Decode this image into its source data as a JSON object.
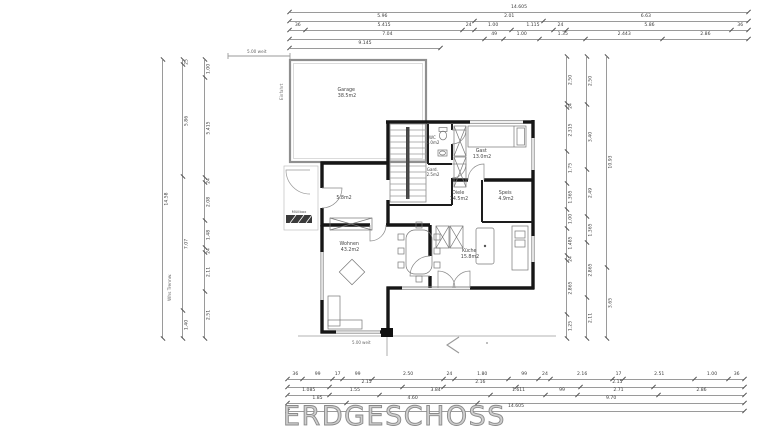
{
  "title": "ERDGESCHOSS",
  "plan": {
    "rooms": [
      {
        "name": "Garage",
        "area": "38.5m2"
      },
      {
        "name": "WC",
        "area": "2.0m2"
      },
      {
        "name": "Gast",
        "area": "13.0m2"
      },
      {
        "name": "Gard.",
        "area": "2.5m2"
      },
      {
        "name": "Diele",
        "area": "14.5m2"
      },
      {
        "name": "Speis",
        "area": "4.9m2"
      },
      {
        "name": "Küche",
        "area": "15.8m2"
      },
      {
        "name": "Wohnen",
        "area": "43.2m2"
      },
      {
        "name": "",
        "area": "5.8m2"
      }
    ],
    "annotations": {
      "fence_top": "5.00 weit",
      "ramp_side": "Einfahrt",
      "bin_label": "Müllbox",
      "terrace_label": "5.00 weit",
      "wall_note": "Whs Trennw."
    },
    "colors": {
      "wall": "#161616",
      "thin_line": "#9a9a9a",
      "dim_text": "#3b3b3b"
    }
  },
  "dimensions": {
    "top": [
      [
        {
          "v": 14.605,
          "l": "14.605"
        }
      ],
      [
        {
          "v": 5.96,
          "l": "5.96"
        },
        {
          "v": 2.01,
          "l": "2.01"
        },
        {
          "v": 6.63,
          "l": "6.63"
        }
      ],
      [
        {
          "v": 0.365,
          "l": "36"
        },
        {
          "v": 5.415,
          "l": "5.415"
        },
        {
          "v": 0.24,
          "l": "24"
        },
        {
          "v": 1.0,
          "l": "1.00"
        },
        {
          "v": 1.115,
          "l": "1.115"
        },
        {
          "v": 0.24,
          "l": "24"
        },
        {
          "v": 5.86,
          "l": "5.86"
        },
        {
          "v": 0.365,
          "l": "36"
        }
      ],
      [
        {
          "v": 7.04,
          "l": "7.04"
        },
        {
          "v": 0.49,
          "l": "49"
        },
        {
          "v": 1.0,
          "l": "1.00"
        },
        {
          "v": 1.35,
          "l": "1.35"
        },
        {
          "v": 2.443,
          "l": "2.443"
        },
        {
          "v": 2.86,
          "l": "2.86"
        }
      ],
      [
        {
          "v": 9.145,
          "l": "9.145"
        }
      ]
    ],
    "bottom": [
      [
        {
          "v": 0.365,
          "l": "36"
        },
        {
          "v": 0.99,
          "l": "99"
        },
        {
          "v": 0.175,
          "l": "17"
        },
        {
          "v": 0.99,
          "l": "99"
        },
        {
          "v": 2.5,
          "l": "2.50"
        },
        {
          "v": 0.24,
          "l": "24"
        },
        {
          "v": 1.8,
          "l": "1.80"
        },
        {
          "v": 0.99,
          "l": "99"
        },
        {
          "v": 0.24,
          "l": "24"
        },
        {
          "v": 2.16,
          "l": "2.16"
        },
        {
          "v": 0.175,
          "l": "17"
        },
        {
          "v": 2.51,
          "l": "2.51"
        },
        {
          "v": 1.0,
          "l": "1.00"
        },
        {
          "v": 0.365,
          "l": "36"
        }
      ],
      [
        {
          "v": 1.45,
          "l": ""
        },
        {
          "v": 2.15,
          "l": "2.15"
        },
        {
          "v": 1.4,
          "l": ""
        },
        {
          "v": 2.16,
          "l": "2.16"
        },
        {
          "v": 2.2,
          "l": ""
        },
        {
          "v": 2.15,
          "l": "2.15"
        },
        {
          "v": 3.1,
          "l": ""
        }
      ],
      [
        {
          "v": 1.085,
          "l": "1.085"
        },
        {
          "v": 1.55,
          "l": "1.55"
        },
        {
          "v": 3.84,
          "l": "3.84"
        },
        {
          "v": 1.611,
          "l": "1.611"
        },
        {
          "v": 0.99,
          "l": "99"
        },
        {
          "v": 2.71,
          "l": "2.71"
        },
        {
          "v": 2.86,
          "l": "2.86"
        }
      ],
      [
        {
          "v": 1.85,
          "l": "1.85"
        },
        {
          "v": 4.6,
          "l": "4.60"
        },
        {
          "v": 9.7,
          "l": "9.70"
        }
      ],
      [
        {
          "v": 14.605,
          "l": "14.605"
        }
      ]
    ],
    "left": [
      [
        {
          "v": 14.58,
          "l": "14.58"
        }
      ],
      [
        {
          "v": 0.25,
          "l": "25"
        },
        {
          "v": 5.86,
          "l": "5.86"
        },
        {
          "v": 7.07,
          "l": "7.07"
        },
        {
          "v": 1.4,
          "l": "1.40"
        }
      ],
      [
        {
          "v": 1.0,
          "l": "1.00"
        },
        {
          "v": 5.415,
          "l": "5.415"
        },
        {
          "v": 0.24,
          "l": "24"
        },
        {
          "v": 2.08,
          "l": "2.08"
        },
        {
          "v": 1.48,
          "l": "1.48"
        },
        {
          "v": 0.24,
          "l": "24"
        },
        {
          "v": 2.11,
          "l": "2.11"
        },
        {
          "v": 2.51,
          "l": "2.51"
        }
      ]
    ],
    "right": [
      [
        {
          "v": 2.5,
          "l": "2.50"
        },
        {
          "v": 0.24,
          "l": "24"
        },
        {
          "v": 2.315,
          "l": "2.315"
        },
        {
          "v": 1.75,
          "l": "1.75"
        },
        {
          "v": 1.365,
          "l": "1.365"
        },
        {
          "v": 1.0,
          "l": "1.00"
        },
        {
          "v": 1.485,
          "l": "1.485"
        },
        {
          "v": 0.24,
          "l": "24"
        },
        {
          "v": 2.865,
          "l": "2.865"
        },
        {
          "v": 1.25,
          "l": "1.25"
        }
      ],
      [
        {
          "v": 2.5,
          "l": "2.50"
        },
        {
          "v": 3.4,
          "l": "3.40"
        },
        {
          "v": 2.49,
          "l": "2.49"
        },
        {
          "v": 1.365,
          "l": "1.365"
        },
        {
          "v": 2.865,
          "l": "2.865"
        },
        {
          "v": 2.11,
          "l": "2.11"
        }
      ],
      [
        {
          "v": 10.93,
          "l": "10.93"
        },
        {
          "v": 3.65,
          "l": "3.65"
        }
      ]
    ]
  }
}
